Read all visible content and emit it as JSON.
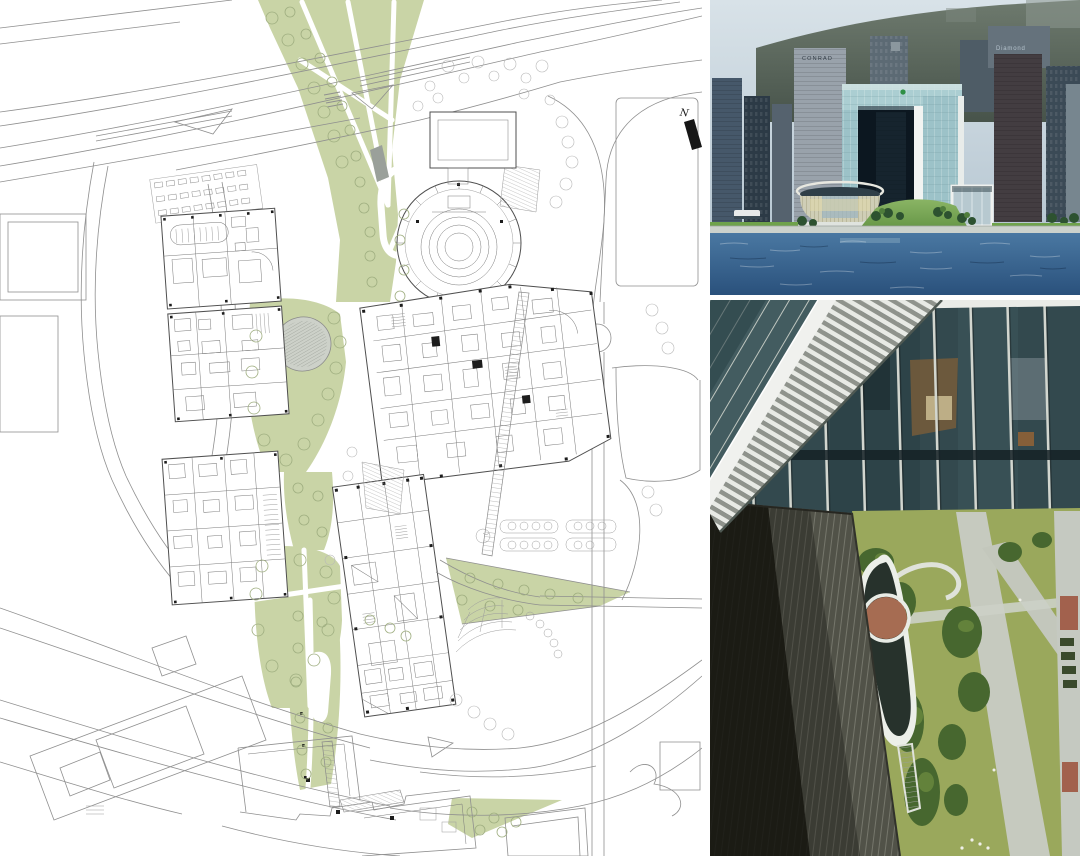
{
  "site_plan": {
    "north_label": "N",
    "colors": {
      "paper": "#ffffff",
      "green": "#c9d4a6",
      "green_deep": "#b9c693",
      "pond": "#cdd1c9",
      "ramp_gray": "#9aa09a",
      "line": "#8f8f8f",
      "building_line": "#4f4f4f",
      "north_black": "#161616"
    }
  },
  "harbour_photo": {
    "signs": {
      "conrad": "CONRAD",
      "diamond": "Diamond"
    },
    "colors": {
      "sky_top": "#d8e2e8",
      "sky_bottom": "#b7c7d2",
      "hill_top": "#6e7a6e",
      "hill_bottom": "#47534a",
      "water_top": "#4a78a2",
      "water_bottom": "#2a517c",
      "glass_beam": "#abced2",
      "glass_leg": "#9cc2c8",
      "arch_opening": "#0c1720",
      "frame_white": "#f2f4f2",
      "lawn": "#79a855",
      "legco_body": "#cfceb6",
      "annex_glass": "#b7c9d0",
      "promenade": "#ccd2cc",
      "boat_white": "#e8eaea"
    }
  },
  "aerial_photo": {
    "colors": {
      "glass": "#33494e",
      "mullion": "#d2d6cf",
      "spandrel": "#152126",
      "beam_white": "#e9ebe7",
      "rail_white": "#f0f1ee",
      "louver_light": "#e8eae5",
      "louver_dark": "#8f938c",
      "wall": "#515248",
      "wall_shadow": "#12120c",
      "lawn": "#9aa85c",
      "tree": "#47672f",
      "path": "#c6cabf",
      "teardrop_white": "#ecefe9",
      "moat": "#27322c",
      "oval_red": "#a66c52",
      "plaza": "#c5c9c1",
      "plaza_red": "#a2614d"
    }
  }
}
